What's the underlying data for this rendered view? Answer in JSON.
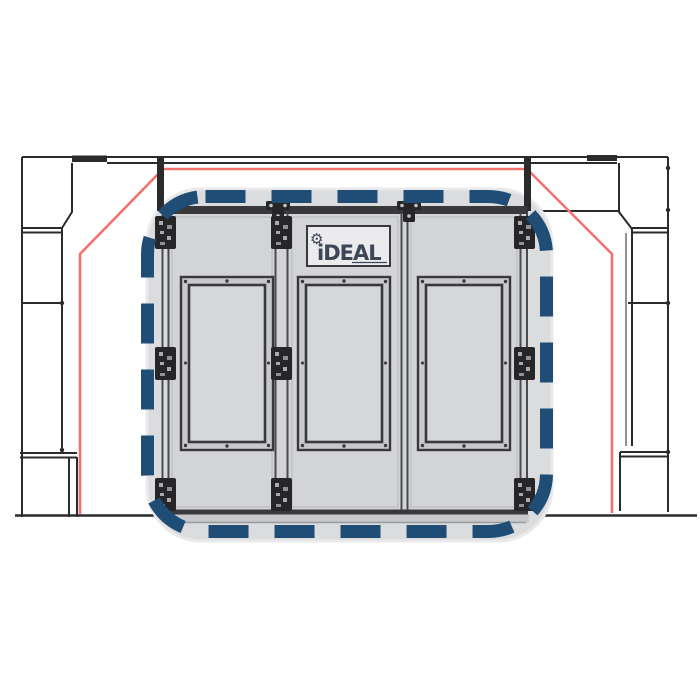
{
  "logo": {
    "text": "iDEAL",
    "gear_glyph": "⚙"
  },
  "colors": {
    "background": "#ffffff",
    "structure_line": "#2b2b2d",
    "secondary_line": "#55565a",
    "guide_red": "#f4726c",
    "highlight_blue": "#1f4d76",
    "backdrop_gray": "#dbdcde",
    "door_gray": "#d3d4d6",
    "frame_band_gray": "#c8c9cb",
    "glass_gray": "#d6d7d9",
    "sill_gray": "#c7c8cb",
    "hardware_dark": "#262628",
    "logo_plate": "#ebebed",
    "logo_text_color": "#3d4656"
  },
  "booth": {
    "door_count": 3,
    "window_count": 3,
    "hinge_count": 9,
    "highlight_style": "dashed rounded rectangle"
  }
}
